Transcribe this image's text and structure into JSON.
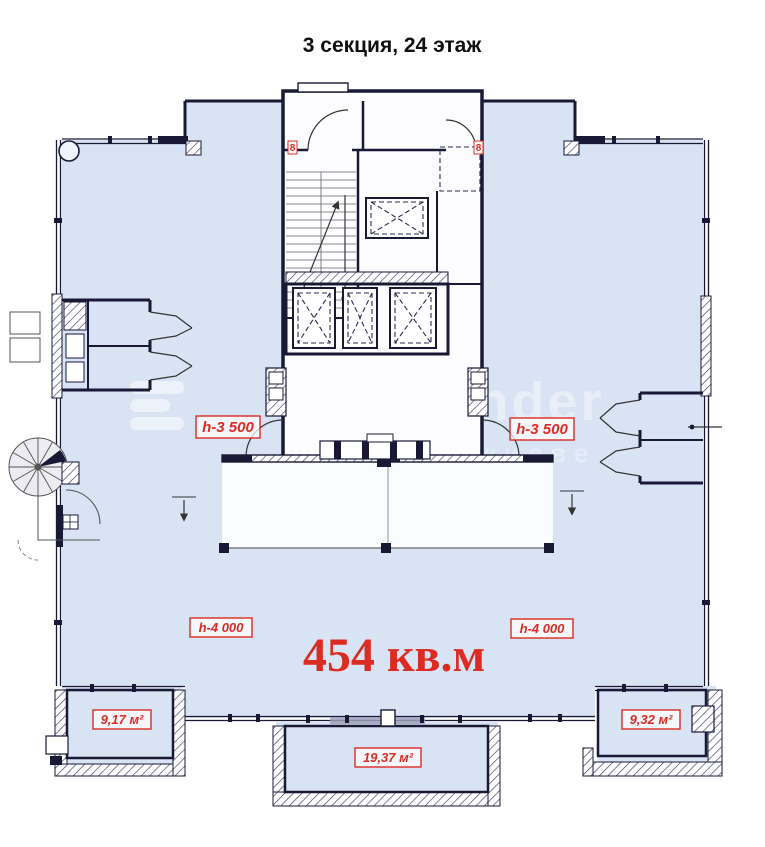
{
  "title": "3 секция, 24 этаж",
  "plan": {
    "total_area": "454 кв.м",
    "ceiling_labels": {
      "upper_left": "h-3 500",
      "upper_right": "h-3 500",
      "lower_left": "h-4 000",
      "lower_right": "h-4 000"
    },
    "balcony_areas": {
      "bottom_left": "9,17 м²",
      "bottom_center": "19,37 м²",
      "bottom_right": "9,32 м²"
    },
    "wall_markers": {
      "left": "8",
      "right": "8"
    },
    "watermark": {
      "fragment": "nder",
      "fragment2": "в киеве"
    },
    "colors": {
      "room_fill": "#d8e4f4",
      "wall": "#191936",
      "accent": "#dc2b22"
    }
  }
}
